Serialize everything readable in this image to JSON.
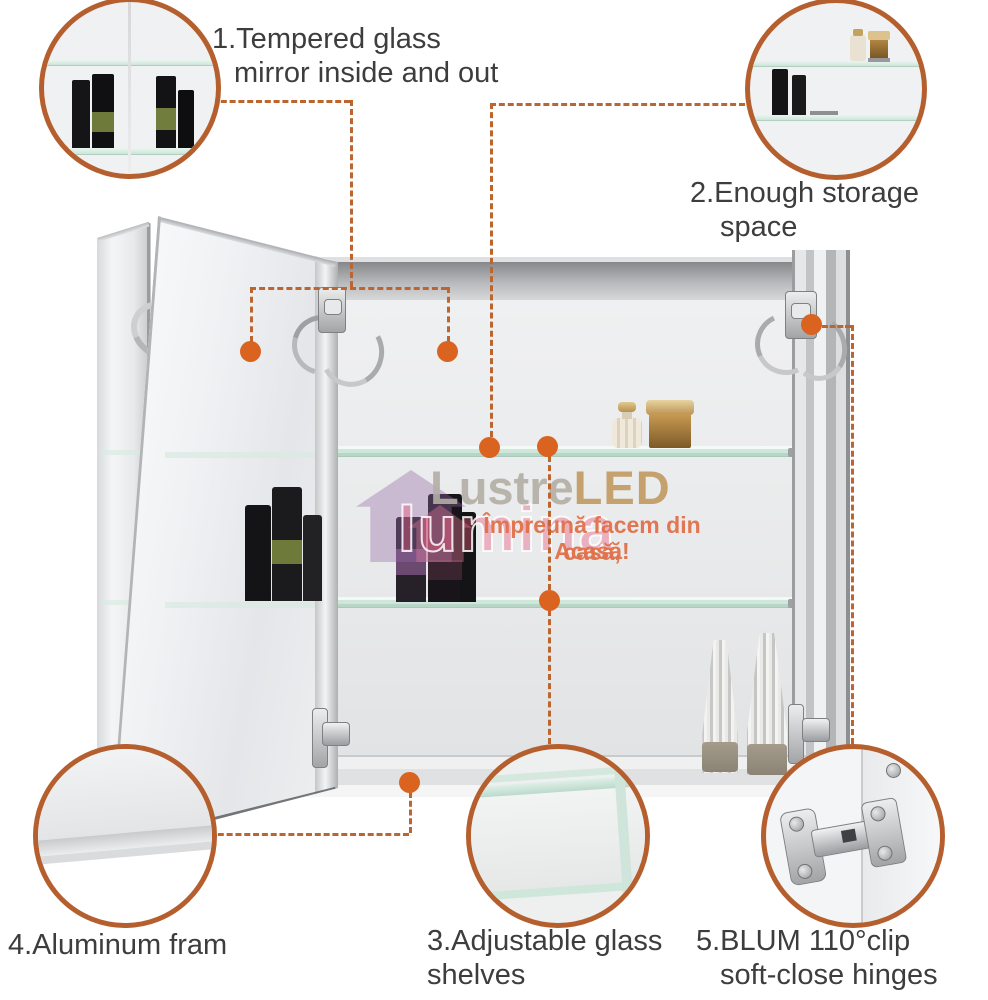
{
  "page": {
    "type": "product-infographic",
    "background": "#ffffff"
  },
  "colors": {
    "accent_dash": "#bd652e",
    "dot_orange": "#d9631f",
    "circle_border": "#b55f2e",
    "label_text": "#3d3d3d",
    "tagline_orange": "#e0714a",
    "brand_gray": "#b3afa6",
    "brand_gold": "#c09a62",
    "watermark_pink": "#e85a82",
    "glass_shelf": "#cfe7db"
  },
  "annotations": {
    "labels": {
      "mirror": {
        "line1": "1.Tempered glass",
        "line2": "mirror inside and out"
      },
      "storage": {
        "line1": "2.Enough storage",
        "line2": "space"
      },
      "shelves": {
        "line1": "3.Adjustable glass",
        "line2": "shelves"
      },
      "frame": {
        "line1": "4.Aluminum fram"
      },
      "hinges": {
        "line1": "5.BLUM 110°clip",
        "line2": "soft-close hinges"
      }
    },
    "callouts": [
      "mirror-interior-detail",
      "storage-shelves-detail",
      "adjustable-glass-shelf-detail",
      "aluminum-frame-detail",
      "blum-hinge-detail"
    ]
  },
  "watermark": {
    "brand_primary": "Lustre",
    "brand_accent": "LED",
    "background_word": "lumina",
    "tagline_line1": "Împreună facem din casă,",
    "tagline_line2": "Acasă!"
  }
}
